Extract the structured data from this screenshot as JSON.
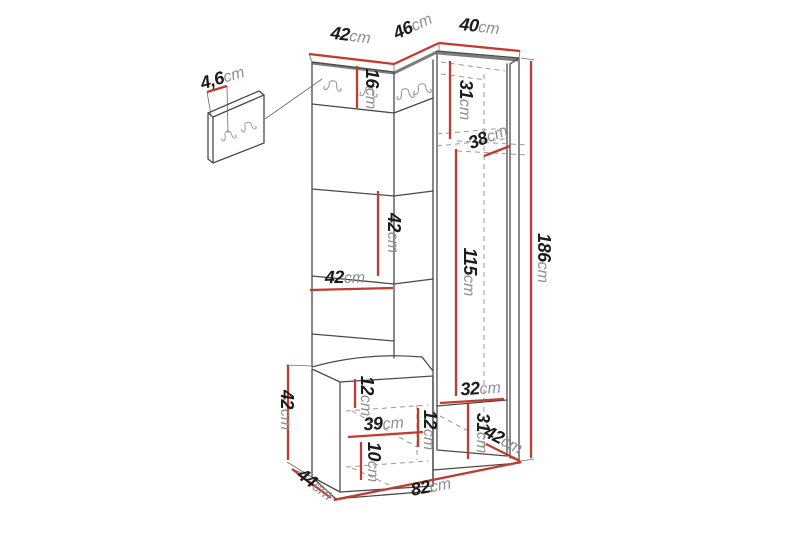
{
  "palette": {
    "background": "#ffffff",
    "dimension_red": "#c23b30",
    "outline_dark": "#4a4a4a",
    "outline_gray": "#8a8a8a",
    "value_text": "#1b1b1b",
    "unit_text": "#8f8f8f",
    "hook_gray": "#a0a0a0"
  },
  "diagram": {
    "kind": "hallway-furniture-dimension-drawing",
    "unit": "cm",
    "dimensions": [
      {
        "name": "wall-panel-thickness",
        "value": "4,6",
        "unit": "cm"
      },
      {
        "name": "left-section-width",
        "value": "42",
        "unit": "cm"
      },
      {
        "name": "corner-section-width",
        "value": "46",
        "unit": "cm"
      },
      {
        "name": "right-section-width",
        "value": "40",
        "unit": "cm"
      },
      {
        "name": "hook-rail-height",
        "value": "16",
        "unit": "cm"
      },
      {
        "name": "right-top-section-height",
        "value": "31",
        "unit": "cm"
      },
      {
        "name": "right-top-depth",
        "value": "38",
        "unit": "cm"
      },
      {
        "name": "middle-section-height",
        "value": "42",
        "unit": "cm"
      },
      {
        "name": "panel-section-width",
        "value": "42",
        "unit": "cm"
      },
      {
        "name": "wardrobe-interior-height",
        "value": "115",
        "unit": "cm"
      },
      {
        "name": "total-height",
        "value": "186",
        "unit": "cm"
      },
      {
        "name": "lower-interior-depth",
        "value": "32",
        "unit": "cm"
      },
      {
        "name": "bench-top-to-shelf",
        "value": "12",
        "unit": "cm"
      },
      {
        "name": "bench-shelf-width",
        "value": "39",
        "unit": "cm"
      },
      {
        "name": "bench-shelf-gap",
        "value": "12",
        "unit": "cm"
      },
      {
        "name": "bench-bottom-height",
        "value": "10",
        "unit": "cm"
      },
      {
        "name": "bench-height",
        "value": "42",
        "unit": "cm"
      },
      {
        "name": "bench-depth",
        "value": "44",
        "unit": "cm"
      },
      {
        "name": "lower-right-section-height",
        "value": "31",
        "unit": "cm"
      },
      {
        "name": "base-depth",
        "value": "42",
        "unit": "cm"
      },
      {
        "name": "total-width",
        "value": "82",
        "unit": "cm"
      }
    ],
    "icons": {
      "coat_hook": "double-coat-hook",
      "main_unit_hook_count": 4,
      "wall_panel_hook_count": 2
    }
  }
}
